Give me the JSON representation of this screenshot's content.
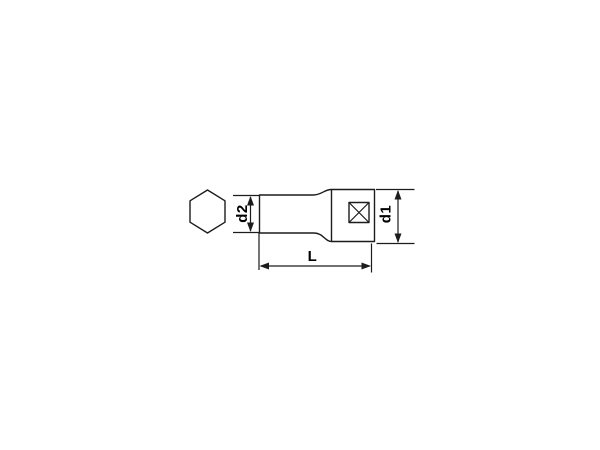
{
  "page": {
    "background_color": "#ffffff"
  },
  "drawing": {
    "kind": "technical-dimension-diagram",
    "line_color": "#1c1c1c",
    "text_color": "#000000",
    "labels": {
      "d2": "d2",
      "d1": "d1",
      "length": "L"
    }
  }
}
